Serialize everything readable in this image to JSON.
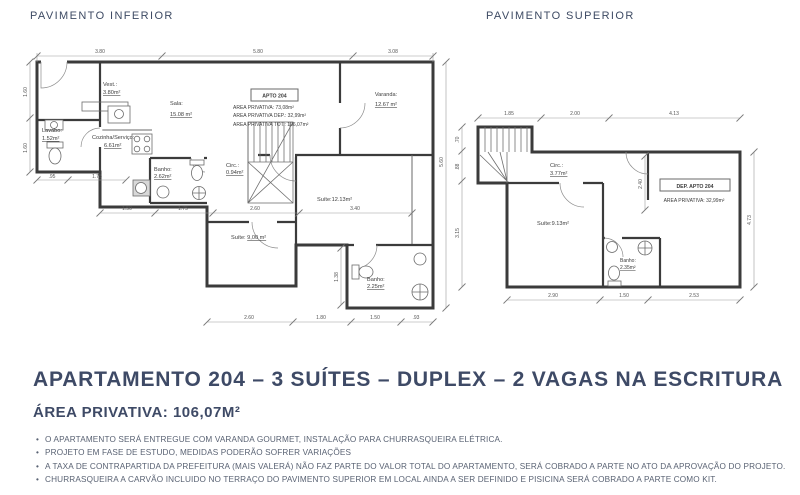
{
  "plan_inferior": {
    "title": "PAVIMENTO INFERIOR",
    "apto_box": "APTO 204",
    "area_lines": [
      "AREA PRIVATIVA: 73,08m²",
      "AREA PRIVATIVA DEP.: 32,99m²",
      "AREA PRIVATIVA TOT.: 106,07m²"
    ],
    "rooms": {
      "vest": {
        "name": "Vest.:",
        "area": "3.80m²"
      },
      "sala": {
        "name": "Sala:",
        "area": "15.08 m²"
      },
      "lavabo": {
        "name": "Lavabo:",
        "area": "1.52m²"
      },
      "cozinha": {
        "name": "Cozinha/Serviço:",
        "area": "6.61m²"
      },
      "circ": {
        "name": "Circ.:",
        "area": "0.94m²"
      },
      "banho1": {
        "name": "Banho:",
        "area": "2.62m²"
      },
      "varanda": {
        "name": "Varanda:",
        "area": "12.67 m²"
      },
      "suite1": {
        "name": "Suíte:",
        "area": "12.13m²"
      },
      "suite2": {
        "name": "Suíte: ",
        "area": "9,00 m²"
      },
      "banho2": {
        "name": "Banho:",
        "area": "2.25m²"
      }
    },
    "dims": {
      "top": [
        "3.80",
        "5.80",
        "3.08"
      ],
      "left": [
        "1.60",
        "1.60"
      ],
      "right": [
        "5.60"
      ],
      "wing": [
        ".95",
        "1.75"
      ],
      "mid": [
        "1.50",
        "1.75",
        "2.60",
        "3.40"
      ],
      "bottom": [
        "2.60",
        "1.80",
        "1.50",
        ".93"
      ],
      "v_banho": "1.38"
    }
  },
  "plan_superior": {
    "title": "PAVIMENTO SUPERIOR",
    "dep_box": "DEP. APTO 204",
    "area_line": "AREA PRIVATIVA: 32,99m²",
    "rooms": {
      "circ": {
        "name": "Circ.:",
        "area": "3.77m²"
      },
      "suite": {
        "name": "Suíte:",
        "area": "9.13m²"
      },
      "banho": {
        "name": "Banho:",
        "area": "2.35m²"
      }
    },
    "dims": {
      "top": [
        "1.85",
        "2.00",
        "4.13"
      ],
      "left": [
        ".70",
        ".88",
        "3.15"
      ],
      "right": [
        "4.73"
      ],
      "bottom": [
        "2.90",
        "1.50",
        "2.53"
      ],
      "v_inner": "2.40"
    }
  },
  "footer": {
    "title": "APARTAMENTO 204 – 3 SUÍTES – DUPLEX – 2 VAGAS NA ESCRITURA",
    "subtitle": "ÁREA PRIVATIVA: 106,07M²",
    "notes": [
      "O APARTAMENTO SERÁ ENTREGUE COM VARANDA GOURMET, INSTALAÇÃO PARA CHURRASQUEIRA ELÉTRICA.",
      "PROJETO EM FASE DE ESTUDO, MEDIDAS PODERÃO SOFRER VARIAÇÕES",
      "A TAXA DE CONTRAPARTIDA DA PREFEITURA (MAIS VALERÁ) NÃO FAZ PARTE DO VALOR TOTAL DO APARTAMENTO, SERÁ COBRADO A PARTE NO ATO DA APROVAÇÃO DO PROJETO.",
      "CHURRASQUEIRA A CARVÃO INCLUIDO NO TERRAÇO DO PAVIMENTO SUPERIOR EM LOCAL AINDA A SER DEFINIDO E PISICINA SERÁ COBRADO A PARTE COMO KIT."
    ],
    "accent_color": "#3e4a66",
    "notes_color": "#596273"
  }
}
